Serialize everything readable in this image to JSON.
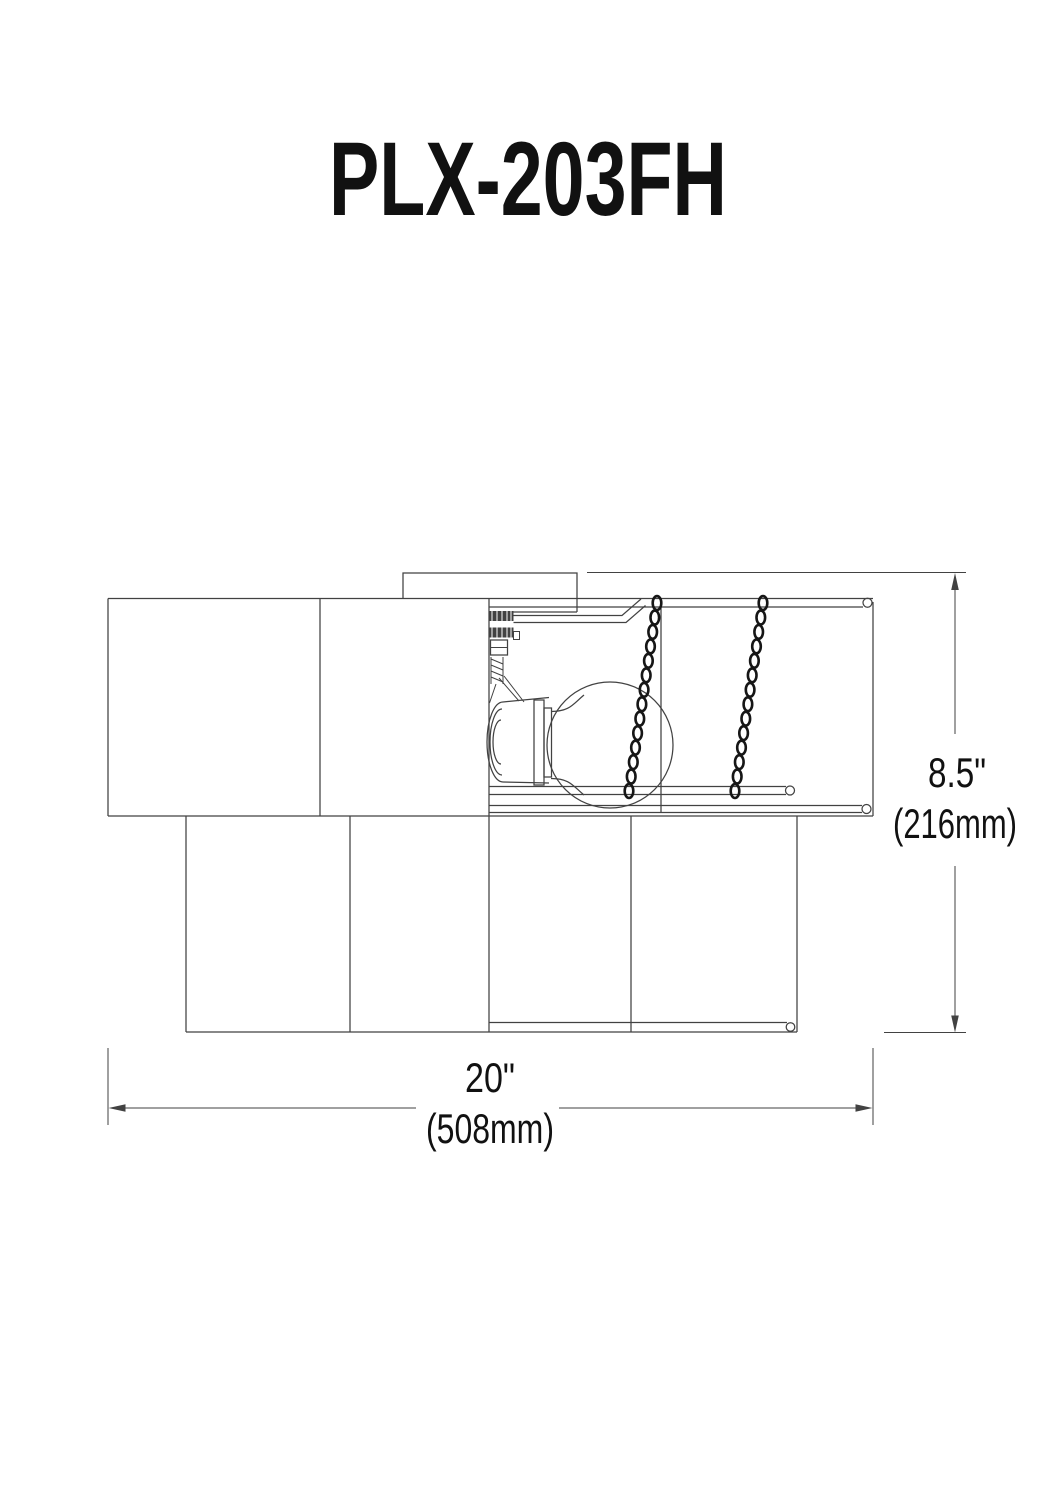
{
  "title": {
    "text": "PLX-203FH"
  },
  "dimensions": {
    "height": {
      "inches": "8.5\"",
      "millimeters": "(216mm)"
    },
    "width": {
      "inches": "20\"",
      "millimeters": "(508mm)"
    }
  },
  "colors": {
    "line": "#424242",
    "chain": "#161616",
    "text": "#111111",
    "background": "#ffffff"
  }
}
